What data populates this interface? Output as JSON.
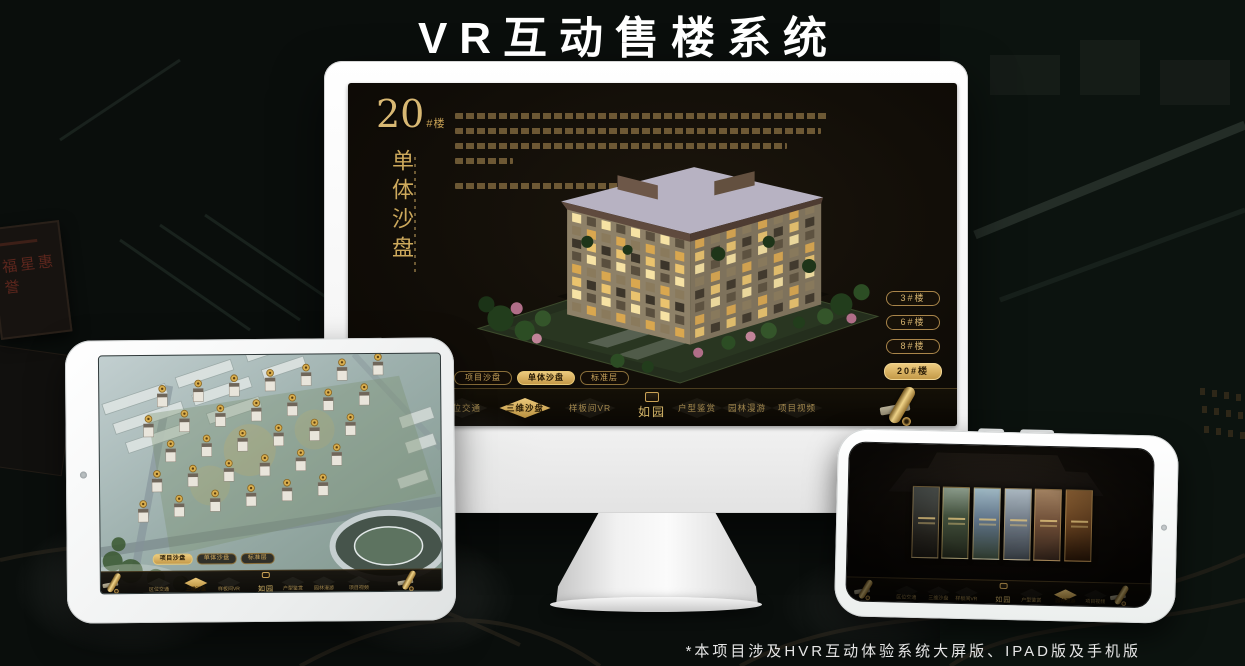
{
  "header": {
    "title": "VR互动售楼系统"
  },
  "footer": {
    "note": "*本项目涉及HVR互动体验系统大屏版、IPAD版及手机版"
  },
  "background": {
    "plaque_text": "福星惠誉"
  },
  "brand": {
    "logo_name": "如园",
    "gold": "#c9a255"
  },
  "monitor": {
    "panel_title": {
      "number": "20",
      "suffix": "#楼",
      "vertical": "单体沙盘"
    },
    "floor_buttons": [
      "3#楼",
      "6#楼",
      "8#楼",
      "20#楼"
    ],
    "active_floor": "20#楼",
    "tabs": [
      "项目沙盘",
      "单体沙盘",
      "标准层"
    ],
    "active_tab": "单体沙盘",
    "nav": [
      "区位交通",
      "三维沙盘",
      "样板间VR",
      "户型鉴赏",
      "园林漫游",
      "项目视频"
    ],
    "active_nav": "三维沙盘"
  },
  "tablet": {
    "tabs": [
      "项目沙盘",
      "单体沙盘",
      "标准层"
    ],
    "active_tab": "项目沙盘",
    "nav": [
      "区位交通",
      "三维沙盘",
      "样板间VR",
      "户型鉴赏",
      "园林漫游",
      "项目视频"
    ],
    "active_nav": "三维沙盘"
  },
  "phone": {
    "nav": [
      "区位交通",
      "三维沙盘",
      "样板间VR",
      "户型鉴赏",
      "园林漫游",
      "项目视频"
    ],
    "active_nav": "园林漫游"
  }
}
